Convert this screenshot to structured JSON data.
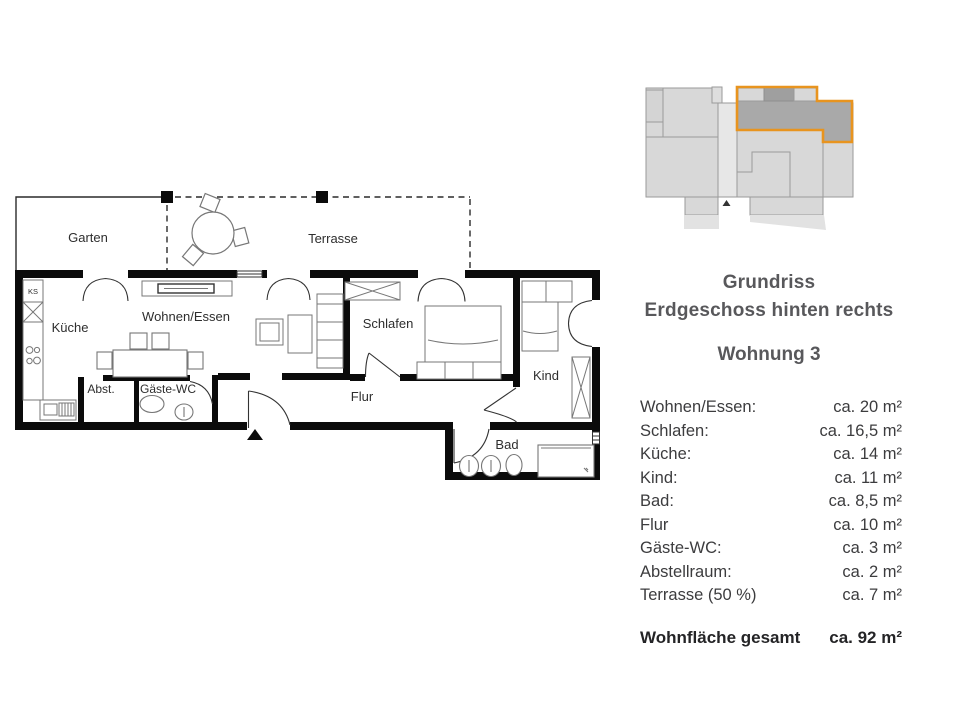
{
  "plan": {
    "labels": {
      "garten": "Garten",
      "terrasse": "Terrasse",
      "kueche": "Küche",
      "wohnen_essen": "Wohnen/Essen",
      "schlafen": "Schlafen",
      "kind": "Kind",
      "flur": "Flur",
      "bad": "Bad",
      "abst": "Abst.",
      "gaeste_wc": "Gäste-WC",
      "ks": "KS"
    }
  },
  "panel": {
    "title_line1": "Grundriss",
    "title_line2": "Erdgeschoss hinten rechts",
    "subtitle": "Wohnung 3",
    "rooms": [
      {
        "label": "Wohnen/Essen:",
        "value": "ca. 20 m²"
      },
      {
        "label": "Schlafen:",
        "value": "ca. 16,5 m²"
      },
      {
        "label": "Küche:",
        "value": "ca. 14 m²"
      },
      {
        "label": "Kind:",
        "value": "ca. 11 m²"
      },
      {
        "label": "Bad:",
        "value": "ca. 8,5 m²"
      },
      {
        "label": "Flur",
        "value": "ca. 10 m²"
      },
      {
        "label": "Gäste-WC:",
        "value": "ca. 3 m²"
      },
      {
        "label": "Abstellraum:",
        "value": "ca. 2 m²"
      },
      {
        "label": "Terrasse (50 %)",
        "value": "ca. 7 m²"
      }
    ],
    "total_label": "Wohnfläche gesamt",
    "total_value": "ca. 92 m²"
  },
  "colors": {
    "accent_orange": "#E8941F",
    "wall_black": "#0b0b0b",
    "building_gray": "#d8d8d8",
    "apartment_dark_gray": "#a9a9a9"
  }
}
